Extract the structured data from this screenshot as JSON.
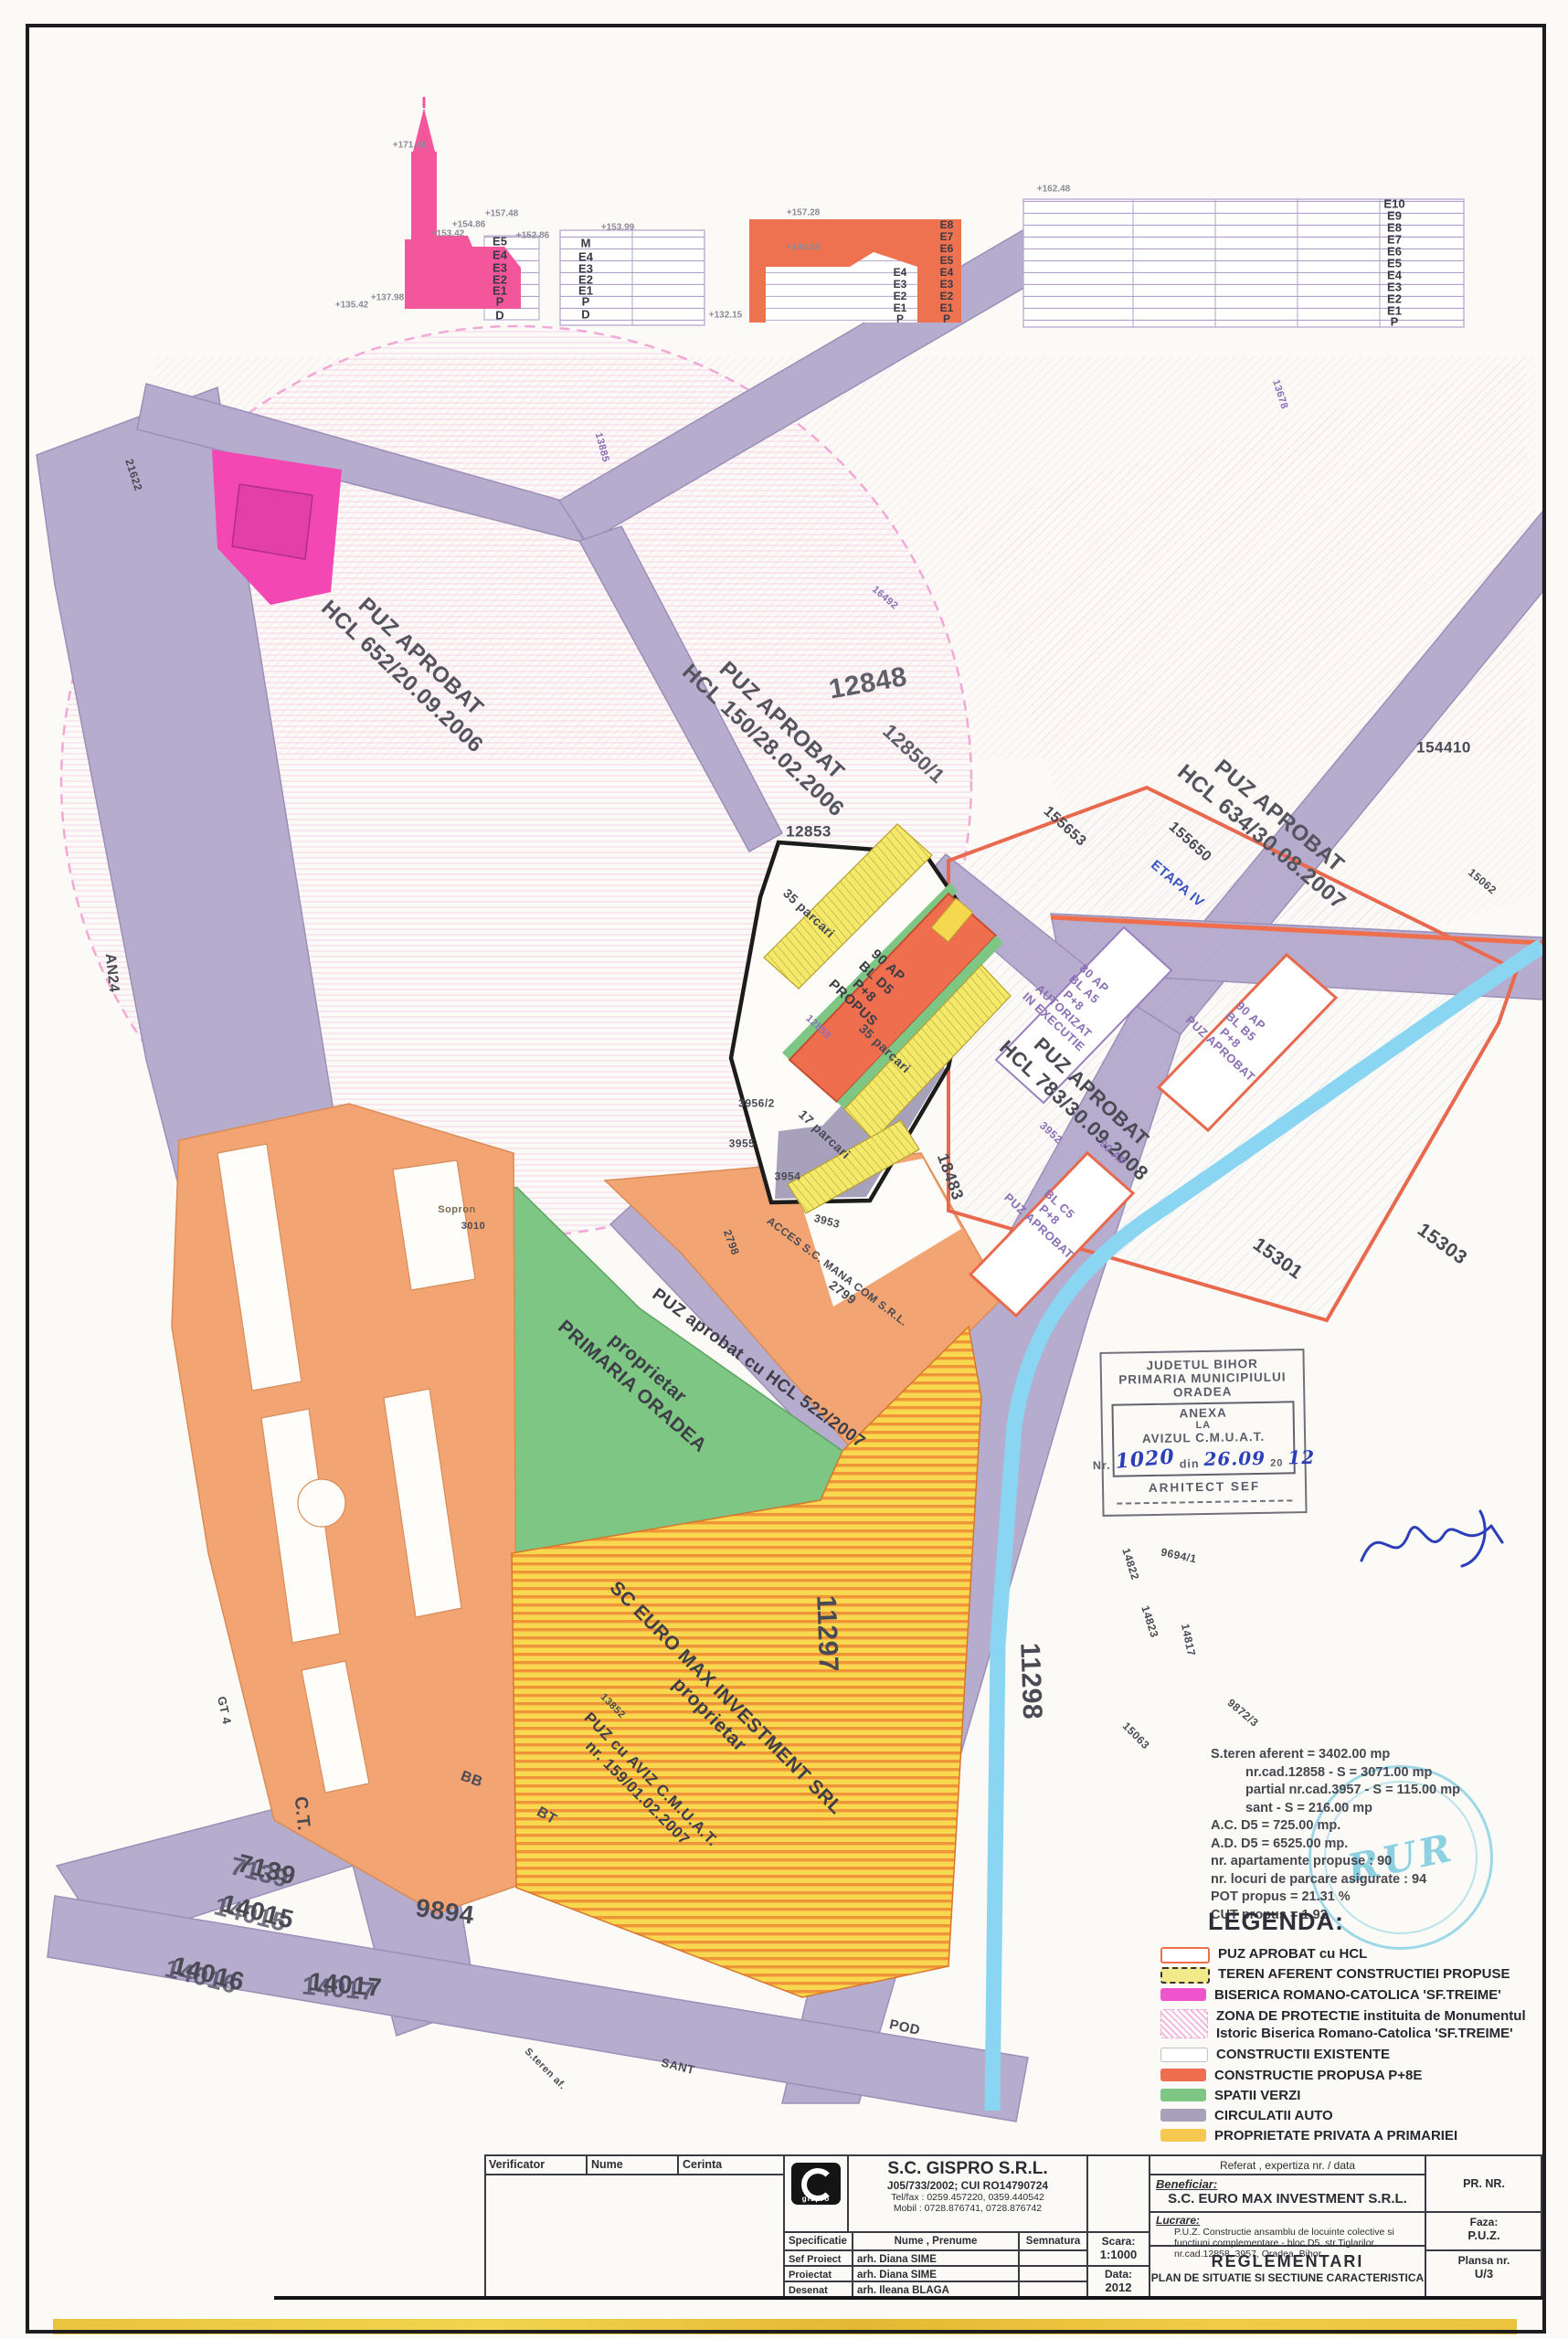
{
  "colors": {
    "road": "#b6accd",
    "water": "#8ad6f2",
    "green": "#7dc683",
    "orange_zone": "#f2a572",
    "proposed_building": "#ee6e4e",
    "church_pink": "#f3569a",
    "biserica_magenta": "#ee55cc",
    "yellow_stripe": "#f8d84e",
    "teren_yellow": "#f2ea8a",
    "privata_yellow": "#f6c84f",
    "hatch_pink": "#f2bade",
    "hatch_purple": "#c9b4e4",
    "boundary_red": "#e8694e",
    "frame": "#1d1d1f",
    "handwriting_blue": "#2a3fb8",
    "stamp_blue": "#42b6d5"
  },
  "elevations": {
    "church": {
      "floors": [
        "E5",
        "E4",
        "E3",
        "E2",
        "E1",
        "P",
        "D"
      ],
      "marks": {
        "top": "+171.48",
        "roof": "+157.48",
        "m1": "+154.86",
        "m2": "+153.42",
        "m3": "+152.86",
        "base": "+137.98",
        "ground": "+135.42"
      }
    },
    "existing": {
      "floors": [
        "M",
        "E4",
        "E3",
        "E2",
        "E1",
        "P",
        "D"
      ],
      "marks": {
        "top": "+153.99",
        "base": "+132.15"
      }
    },
    "proposed": {
      "floors_outer": [
        "E8",
        "E7",
        "E6",
        "E5",
        "E4",
        "E3",
        "E2",
        "E1",
        "P"
      ],
      "floors_inner": [
        "E4",
        "E3",
        "E2",
        "E1",
        "P"
      ],
      "marks": {
        "top": "+157.28",
        "inner": "+148.65"
      }
    },
    "tall": {
      "floors": [
        "E10",
        "E9",
        "E8",
        "E7",
        "E6",
        "E5",
        "E4",
        "E3",
        "E2",
        "E1",
        "P"
      ],
      "marks": {
        "top": "+162.48"
      }
    }
  },
  "map_labels": [
    {
      "text": "12848"
    },
    {
      "text": "PUZ APROBAT\nHCL 652/20.09.2006"
    },
    {
      "text": "PUZ APROBAT\nHCL 150/28.02.2006"
    },
    {
      "text": "12850/1"
    },
    {
      "text": "PUZ APROBAT\nHCL 634/30.08.2007"
    },
    {
      "text": "ETAPA IV"
    },
    {
      "text": "155650"
    },
    {
      "text": "155653"
    },
    {
      "text": "154410"
    },
    {
      "text": "12853"
    },
    {
      "text": "90 AP\nBL D5\nP+8\nPROPUS"
    },
    {
      "text": "35 parcari"
    },
    {
      "text": "35 parcari"
    },
    {
      "text": "17 parcari"
    },
    {
      "text": "12858"
    },
    {
      "text": "80 AP\nBL A5\nP+8\nAUTORIZAT\nIN EXECUTIE"
    },
    {
      "text": "PUZ APROBAT\nHCL 783/30.09.2008"
    },
    {
      "text": "90 AP\nBL B5\nP+8\nPUZ APROBAT"
    },
    {
      "text": "BL C5\nP+8\nPUZ APROBAT"
    },
    {
      "text": "3952"
    },
    {
      "text": "90 AP"
    },
    {
      "text": "18483"
    },
    {
      "text": "3953"
    },
    {
      "text": "3954"
    },
    {
      "text": "3955"
    },
    {
      "text": "3956/2"
    },
    {
      "text": "Sopron"
    },
    {
      "text": "3010"
    },
    {
      "text": "ACCES S.C. MANA COM S.R.L."
    },
    {
      "text": "2799"
    },
    {
      "text": "2798"
    },
    {
      "text": "PUZ aprobat cu HCL 522/2007"
    },
    {
      "text": "proprietar\nPRIMARIA ORADEA"
    },
    {
      "text": "SC EURO MAX INVESTMENT SRL\nproprietar"
    },
    {
      "text": "PUZ cu AVIZ C.M.U.A.T.\nnr. 159/01.02.2007"
    },
    {
      "text": "13852"
    },
    {
      "text": "BT"
    },
    {
      "text": "BB"
    },
    {
      "text": "GT 4"
    },
    {
      "text": "C.T."
    },
    {
      "text": "7139"
    },
    {
      "text": "14015"
    },
    {
      "text": "14016"
    },
    {
      "text": "9894"
    },
    {
      "text": "14017"
    },
    {
      "text": "11297"
    },
    {
      "text": "11298"
    },
    {
      "text": "15301"
    },
    {
      "text": "15303"
    },
    {
      "text": "POD"
    },
    {
      "text": "SANT"
    },
    {
      "text": "S.teren af."
    },
    {
      "text": "AN24"
    },
    {
      "text": "21622"
    },
    {
      "text": "16492"
    },
    {
      "text": "13885"
    },
    {
      "text": "13678"
    },
    {
      "text": "15062"
    },
    {
      "text": "15063"
    },
    {
      "text": "14822"
    },
    {
      "text": "14823"
    },
    {
      "text": "14817"
    },
    {
      "text": "9694/1"
    },
    {
      "text": "9872/3"
    }
  ],
  "site_stats": {
    "lines": [
      "S.teren aferent = 3402.00 mp",
      "nr.cad.12858 - S = 3071.00 mp",
      "partial nr.cad.3957 - S = 115.00 mp",
      "sant - S = 216.00 mp",
      "A.C. D5 = 725.00 mp.",
      "A.D. D5 = 6525.00 mp.",
      "nr. apartamente propuse : 90",
      "nr. locuri de parcare asigurate : 94",
      "POT propus = 21.31 %",
      "CUT propus = 1.92"
    ]
  },
  "legend": {
    "title": "LEGENDA:",
    "items": [
      {
        "label": "PUZ APROBAT cu HCL"
      },
      {
        "label": "TEREN AFERENT CONSTRUCTIEI PROPUSE"
      },
      {
        "label": "BISERICA ROMANO-CATOLICA 'SF.TREIME'"
      },
      {
        "label": "ZONA DE PROTECTIE instituita de Monumentul Istoric Biserica Romano-Catolica 'SF.TREIME'"
      },
      {
        "label": "CONSTRUCTII EXISTENTE"
      },
      {
        "label": "CONSTRUCTIE PROPUSA P+8E"
      },
      {
        "label": "SPATII VERZI"
      },
      {
        "label": "CIRCULATII AUTO"
      },
      {
        "label": "PROPRIETATE PRIVATA A PRIMARIEI"
      }
    ]
  },
  "stamp_anexa": {
    "line1": "JUDETUL BIHOR",
    "line2": "PRIMARIA MUNICIPIULUI",
    "line3": "ORADEA",
    "anexa": "ANEXA",
    "la": "LA",
    "avizul": "AVIZUL C.M.U.A.T.",
    "nr_label": "Nr.",
    "nr_value": "1020",
    "din_label": "din",
    "din_value": "26.09",
    "year_prefix": "20",
    "year_value": "12",
    "arhitect": "ARHITECT SEF"
  },
  "stamp_rur": {
    "text": "RUR"
  },
  "title_block": {
    "row1": {
      "verificator": "Verificator",
      "nume": "Nume",
      "cerinta": "Cerinta",
      "referat": "Referat , expertiza nr. / data",
      "pr_nr": "PR. NR."
    },
    "company": {
      "name": "S.C. GISPRO S.R.L.",
      "reg": "J05/733/2002; CUI RO14790724",
      "telfax": "Tel/fax : 0259.457220, 0359.440542",
      "mobil": "Mobil : 0728.876741, 0728.876742"
    },
    "table": {
      "headers": [
        "Specificatie",
        "Nume , Prenume",
        "Semnatura"
      ],
      "rows": [
        {
          "spec": "Sef Proiect",
          "name": "arh. Diana SIME"
        },
        {
          "spec": "Proiectat",
          "name": "arh. Diana SIME"
        },
        {
          "spec": "Desenat",
          "name": "arh. Ileana BLAGA"
        }
      ]
    },
    "scara_label": "Scara:",
    "scara": "1:1000",
    "data_label": "Data:",
    "data": "2012",
    "beneficiar_label": "Beneficiar:",
    "beneficiar": "S.C. EURO MAX INVESTMENT S.R.L.",
    "lucrare_label": "Lucrare:",
    "lucrare": "P.U.Z. Constructie ansamblu de locuinte colective si functiuni complementare - bloc D5, str.Tiglarilor, nr.cad.12858, 3957, Oradea, Bihor",
    "plansa_title": "REGLEMENTARI",
    "plansa_subtitle": "PLAN DE SITUATIE SI SECTIUNE CARACTERISTICA",
    "faza_label": "Faza:",
    "faza": "P.U.Z.",
    "plansa_label": "Plansa nr.",
    "plansa_nr": "U/3"
  }
}
